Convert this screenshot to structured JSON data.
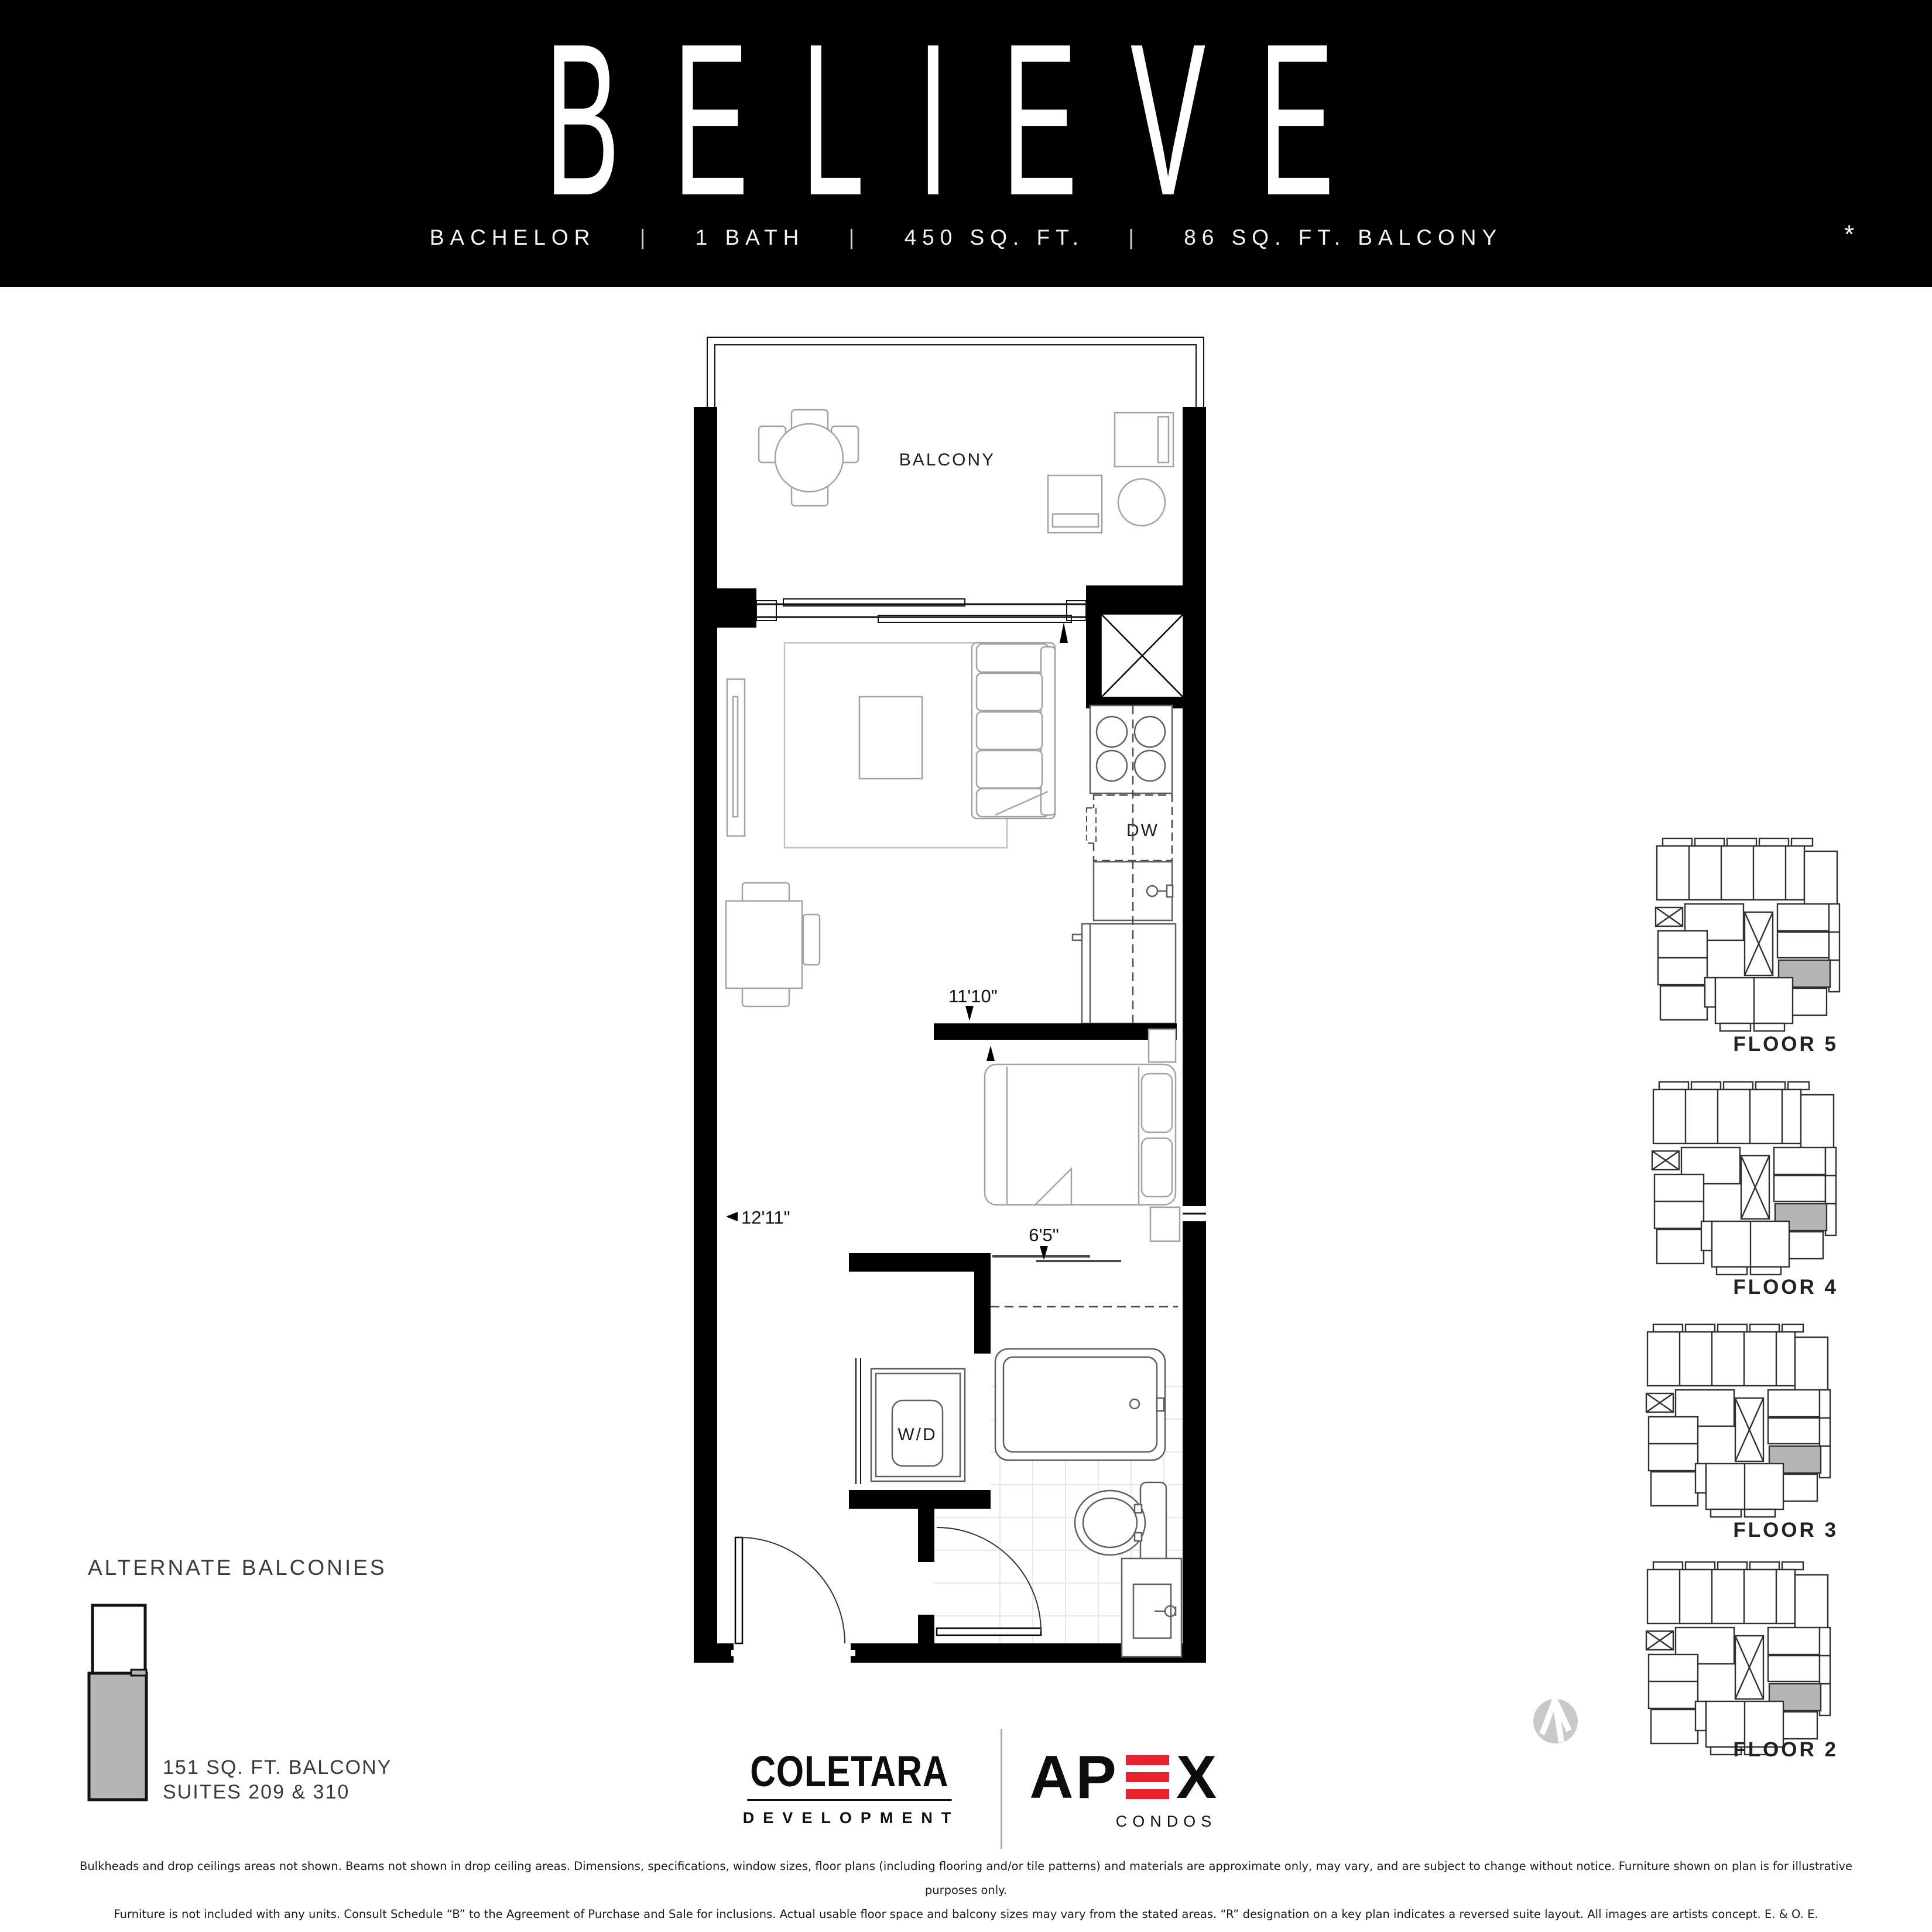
{
  "header": {
    "title": "BELIEVE",
    "specs": [
      "BACHELOR",
      "1 BATH",
      "450 SQ. FT.",
      "86 SQ. FT. BALCONY"
    ],
    "separator": "|",
    "asterisk": "*"
  },
  "plan": {
    "balcony_label": "BALCONY",
    "dishwasher_label": "DW",
    "washer_dryer_label": "W/D",
    "dim_living_width": "11'10\"",
    "dim_living_length": "12'11\"",
    "dim_closet": "6'5\""
  },
  "alternate_balconies": {
    "title": "ALTERNATE BALCONIES",
    "area_line": "151 SQ. FT.  BALCONY",
    "suites_line": "SUITES 209 & 310"
  },
  "key_plans": {
    "floors": [
      {
        "label": "FLOOR 5"
      },
      {
        "label": "FLOOR 4"
      },
      {
        "label": "FLOOR 3"
      },
      {
        "label": "FLOOR 2"
      }
    ]
  },
  "logos": {
    "coletara_name": "COLETARA",
    "coletara_sub": "DEVELOPMENT",
    "apex_prefix": "AP",
    "apex_suffix": "X",
    "apex_sub": "CONDOS"
  },
  "disclaimer": {
    "line1": "Bulkheads and drop ceilings areas not shown. Beams not shown in drop ceiling areas. Dimensions, specifications, window sizes, floor plans (including flooring and/or tile patterns) and materials are approximate only, may vary, and are subject to change without notice. Furniture shown on plan is for illustrative purposes only.",
    "line2": "Furniture is not included with any units. Consult Schedule “B” to the Agreement of Purchase and Sale for inclusions. Actual usable floor space and balcony sizes may vary from the stated areas. “R” designation on a key plan indicates a reversed suite layout. All images are artists concept. E. & O. E."
  },
  "colors": {
    "header_bg": "#000000",
    "apex_red": "#e8232d",
    "suite_highlight_gray": "#b5b5b5",
    "compass_gray": "#c9c9c9"
  }
}
